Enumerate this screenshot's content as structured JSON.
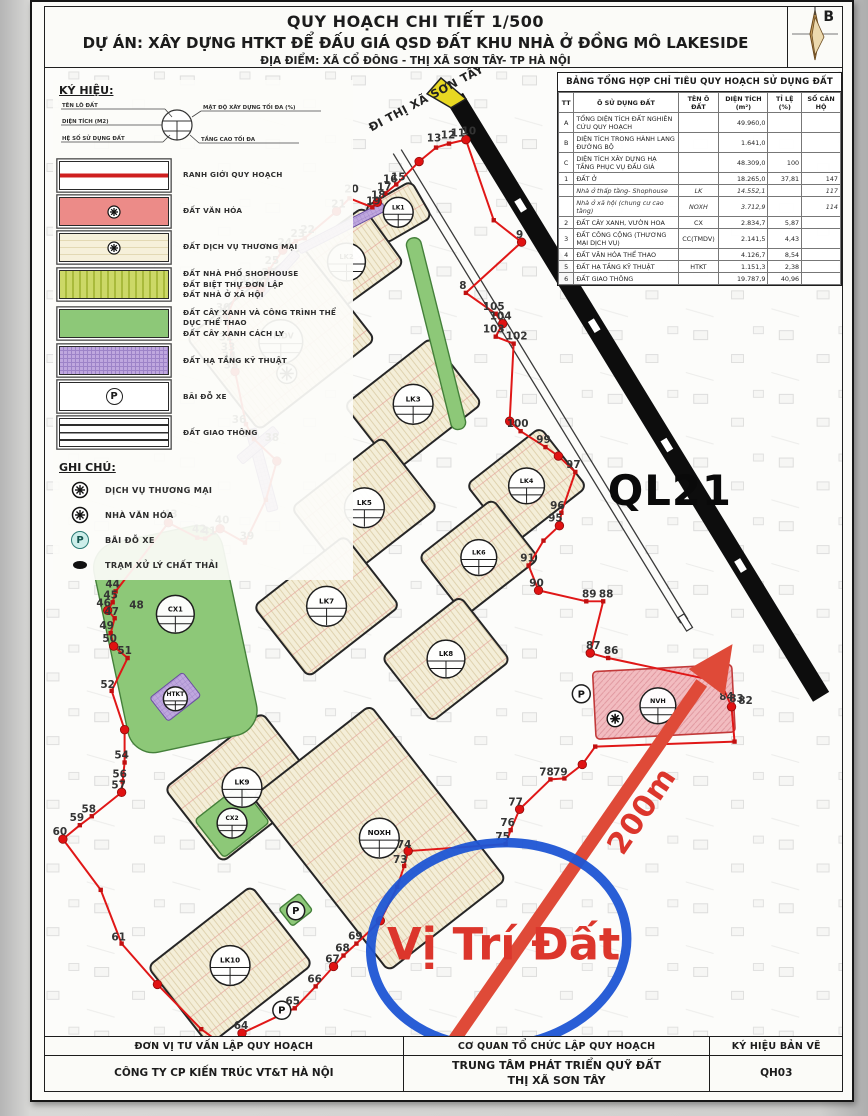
{
  "colors": {
    "boundary_red": "#e01717",
    "annotation_blue": "#1d55d4",
    "annotation_red": "#dc362c",
    "highway_black": "#0d0d0d",
    "block_cream": "#f4eed8",
    "green_area": "#8dc878",
    "purple_htkt": "#bfa7de",
    "pink_culture": "#f2bcc0",
    "direction_arrow_yellow": "#e8d822"
  },
  "title_block": {
    "line1": "QUY HOẠCH CHI TIẾT 1/500",
    "line2": "DỰ ÁN: XÂY DỰNG HTKT ĐỂ ĐẤU GIÁ QSD ĐẤT KHU NHÀ Ở ĐỒNG MÔ LAKESIDE",
    "line3": "ĐỊA ĐIỂM: XÃ CỔ ĐÔNG - THỊ XÃ SƠN TÂY- TP HÀ NỘI",
    "compass_label": "B"
  },
  "legend": {
    "heading": "KÝ HIỆU:",
    "stamp_labels": {
      "left": [
        "TÊN LÔ ĐẤT",
        "DIỆN TÍCH (M2)",
        "HỆ SỐ SỬ DỤNG ĐẤT"
      ],
      "right": [
        "MẬT ĐỘ XÂY DỰNG TỐI ĐA (%)",
        "TẦNG CAO TỐI ĐA"
      ]
    },
    "items": [
      {
        "key": "boundary",
        "lines": [
          "RANH GIỚI QUY HOẠCH"
        ]
      },
      {
        "key": "culture",
        "glyph": true,
        "lines": [
          "ĐẤT VĂN HÓA"
        ]
      },
      {
        "key": "commerce",
        "glyph": true,
        "lines": [
          "ĐẤT DỊCH VỤ THƯƠNG MẠI"
        ]
      },
      {
        "key": "shophouse",
        "lines": [
          "ĐẤT NHÀ PHỐ SHOPHOUSE",
          "ĐẤT BIỆT THỰ ĐƠN LẬP",
          "ĐẤT NHÀ Ở XÃ HỘI"
        ]
      },
      {
        "key": "green",
        "lines": [
          "ĐẤT CÂY XANH VÀ CÔNG TRÌNH THỂ DỤC THỂ THAO",
          "ĐẤT CÂY XANH CÁCH LY"
        ]
      },
      {
        "key": "htkt",
        "lines": [
          "ĐẤT HẠ TẦNG KỸ THUẬT"
        ]
      },
      {
        "key": "parking",
        "lines": [
          "BÃI ĐỖ XE"
        ]
      },
      {
        "key": "road",
        "lines": [
          "ĐẤT GIAO THÔNG"
        ]
      }
    ],
    "notes_heading": "GHI CHÚ:",
    "notes": [
      {
        "icon": "commerce",
        "label": "DỊCH VỤ THƯƠNG MẠI"
      },
      {
        "icon": "culture",
        "label": "NHÀ VĂN HÓA"
      },
      {
        "icon": "parking",
        "label": "BÃI ĐỖ XE"
      },
      {
        "icon": "waste",
        "label": "TRẠM XỬ LÝ CHẤT THẢI"
      }
    ]
  },
  "summary_table": {
    "title": "BẢNG TỔNG HỢP CHỈ TIÊU QUY HOẠCH SỬ DỤNG ĐẤT",
    "headers": [
      "TT",
      "Ô SỬ DỤNG ĐẤT",
      "TÊN Ô ĐẤT",
      "DIỆN TÍCH (m²)",
      "TỈ LỆ (%)",
      "SỐ CĂN HỘ"
    ],
    "rows": [
      {
        "tt": "A",
        "name": "TỔNG DIỆN TÍCH ĐẤT NGHIÊN CỨU QUY HOẠCH",
        "code": "",
        "area": "49.960,0",
        "pct": "",
        "units": ""
      },
      {
        "tt": "B",
        "name": "DIỆN TÍCH TRONG HÀNH LANG ĐƯỜNG BỘ",
        "code": "",
        "area": "1.641,0",
        "pct": "",
        "units": ""
      },
      {
        "tt": "C",
        "name": "DIỆN TÍCH XÂY DỰNG HẠ TẦNG PHỤC VỤ ĐẤU GIÁ",
        "code": "",
        "area": "48.309,0",
        "pct": "100",
        "units": ""
      },
      {
        "tt": "1",
        "name": "ĐẤT Ở",
        "code": "",
        "area": "18.265,0",
        "pct": "37,81",
        "units": "147"
      },
      {
        "tt": "",
        "name": "Nhà ở thấp tầng- Shophouse",
        "code": "LK",
        "area": "14.552,1",
        "pct": "",
        "units": "117",
        "sub": true
      },
      {
        "tt": "",
        "name": "Nhà ở xã hội (chung cư cao tầng)",
        "code": "NOXH",
        "area": "3.712,9",
        "pct": "",
        "units": "114",
        "sub": true
      },
      {
        "tt": "2",
        "name": "ĐẤT CÂY XANH, VƯỜN HOA",
        "code": "CX",
        "area": "2.834,7",
        "pct": "5,87",
        "units": ""
      },
      {
        "tt": "3",
        "name": "ĐẤT CÔNG CỘNG (THƯƠNG MẠI DỊCH VỤ)",
        "code": "CC(TMDV)",
        "area": "2.141,5",
        "pct": "4,43",
        "units": ""
      },
      {
        "tt": "4",
        "name": "ĐẤT VĂN HÓA THỂ THAO",
        "code": "",
        "area": "4.126,7",
        "pct": "8,54",
        "units": ""
      },
      {
        "tt": "5",
        "name": "ĐẤT HẠ TẦNG KỸ THUẬT",
        "code": "HTKT",
        "area": "1.151,3",
        "pct": "2,38",
        "units": ""
      },
      {
        "tt": "6",
        "name": "ĐẤT GIAO THÔNG",
        "code": "",
        "area": "19.787,9",
        "pct": "40,96",
        "units": ""
      }
    ]
  },
  "map": {
    "annotations": {
      "ql21": "QL21",
      "distance": "200m",
      "site_label": "Vị Trí Đất",
      "direction": "ĐI THỊ XÃ SƠN TÂY"
    },
    "blocks": [
      {
        "x": 399,
        "y": 211,
        "w": 54,
        "h": 42,
        "rot": -30,
        "f": "cream"
      },
      {
        "x": 347,
        "y": 261,
        "w": 92,
        "h": 70,
        "rot": -36,
        "f": "cream"
      },
      {
        "x": 281,
        "y": 338,
        "w": 148,
        "h": 118,
        "rot": -38,
        "f": "cream"
      },
      {
        "x": 414,
        "y": 404,
        "w": 110,
        "h": 84,
        "rot": -38,
        "f": "cream"
      },
      {
        "x": 365,
        "y": 508,
        "w": 116,
        "h": 90,
        "rot": -38,
        "f": "cream"
      },
      {
        "x": 528,
        "y": 486,
        "w": 94,
        "h": 76,
        "rot": -38,
        "f": "cream"
      },
      {
        "x": 480,
        "y": 558,
        "w": 94,
        "h": 76,
        "rot": -38,
        "f": "cream"
      },
      {
        "x": 327,
        "y": 607,
        "w": 116,
        "h": 90,
        "rot": -38,
        "f": "cream"
      },
      {
        "x": 447,
        "y": 660,
        "w": 100,
        "h": 82,
        "rot": -38,
        "f": "cream"
      },
      {
        "x": 242,
        "y": 789,
        "w": 124,
        "h": 94,
        "rot": -38,
        "f": "cream"
      },
      {
        "x": 230,
        "y": 968,
        "w": 132,
        "h": 100,
        "rot": -38,
        "f": "cream"
      },
      {
        "x": 380,
        "y": 840,
        "w": 150,
        "h": 222,
        "rot": -38,
        "f": "cream"
      },
      {
        "x": 175,
        "y": 640,
        "w": 132,
        "h": 215,
        "rot": -12,
        "f": "green",
        "rx": 26
      },
      {
        "x": 232,
        "y": 823,
        "w": 58,
        "h": 48,
        "rot": -38,
        "f": "green",
        "rx": 4
      },
      {
        "x": 437,
        "y": 333,
        "w": 15,
        "h": 198,
        "rot": -14,
        "f": "green",
        "rx": 7
      },
      {
        "x": 296,
        "y": 912,
        "w": 26,
        "h": 22,
        "rot": -38,
        "f": "green",
        "rx": 3
      },
      {
        "x": 342,
        "y": 227,
        "w": 96,
        "h": 9,
        "rot": -27,
        "f": "purple",
        "rx": 2
      },
      {
        "x": 277,
        "y": 274,
        "w": 60,
        "h": 9,
        "rot": -48,
        "f": "purple",
        "rx": 2
      },
      {
        "x": 262,
        "y": 470,
        "w": 11,
        "h": 85,
        "rot": -15,
        "f": "purple",
        "rx": 2
      },
      {
        "x": 258,
        "y": 445,
        "w": 48,
        "h": 10,
        "rot": -40,
        "f": "purple",
        "rx": 2
      },
      {
        "x": 175,
        "y": 698,
        "w": 42,
        "h": 30,
        "rot": -38,
        "f": "purple",
        "rx": 3
      },
      {
        "x": 666,
        "y": 703,
        "w": 140,
        "h": 68,
        "rot": -3,
        "f": "pink",
        "rx": 4
      }
    ],
    "stamps": [
      {
        "x": 399,
        "y": 211,
        "t": "LK1",
        "r": 15
      },
      {
        "x": 347,
        "y": 261,
        "t": "LK2",
        "r": 19
      },
      {
        "x": 281,
        "y": 341,
        "t": "TMDV",
        "r": 22
      },
      {
        "x": 414,
        "y": 404,
        "t": "LK3",
        "r": 20
      },
      {
        "x": 528,
        "y": 486,
        "t": "LK4",
        "r": 18
      },
      {
        "x": 365,
        "y": 508,
        "t": "LK5",
        "r": 20
      },
      {
        "x": 480,
        "y": 558,
        "t": "LK6",
        "r": 18
      },
      {
        "x": 327,
        "y": 607,
        "t": "LK7",
        "r": 20
      },
      {
        "x": 447,
        "y": 660,
        "t": "LK8",
        "r": 19
      },
      {
        "x": 175,
        "y": 615,
        "t": "CX1",
        "r": 19
      },
      {
        "x": 242,
        "y": 789,
        "t": "LK9",
        "r": 20
      },
      {
        "x": 232,
        "y": 825,
        "t": "CX2",
        "r": 15
      },
      {
        "x": 380,
        "y": 840,
        "t": "NOXH",
        "r": 20
      },
      {
        "x": 230,
        "y": 968,
        "t": "LK10",
        "r": 20
      },
      {
        "x": 660,
        "y": 707,
        "t": "NVH",
        "r": 18
      },
      {
        "x": 175,
        "y": 700,
        "t": "HTKT",
        "r": 12
      },
      {
        "x": 583,
        "y": 695,
        "t": "P",
        "r": 9
      },
      {
        "x": 296,
        "y": 913,
        "t": "P",
        "r": 9
      },
      {
        "x": 282,
        "y": 1013,
        "t": "P",
        "r": 9
      }
    ],
    "icons": [
      {
        "x": 287,
        "y": 373,
        "r": 10,
        "name": "commerce-icon"
      },
      {
        "x": 617,
        "y": 720,
        "r": 8,
        "name": "culture-icon"
      }
    ],
    "boundary": [
      [
        467,
        138
      ],
      [
        450,
        142
      ],
      [
        437,
        146
      ],
      [
        420,
        160
      ],
      [
        397,
        183
      ],
      [
        386,
        192
      ],
      [
        378,
        201
      ],
      [
        373,
        206
      ],
      [
        350,
        197
      ],
      [
        337,
        210
      ],
      [
        305,
        237
      ],
      [
        296,
        240
      ],
      [
        283,
        249
      ],
      [
        270,
        268
      ],
      [
        267,
        279
      ],
      [
        261,
        288
      ],
      [
        251,
        286
      ],
      [
        239,
        287
      ],
      [
        227,
        315
      ],
      [
        229,
        335
      ],
      [
        232,
        353
      ],
      [
        235,
        371
      ],
      [
        246,
        424
      ],
      [
        254,
        439
      ],
      [
        277,
        461
      ],
      [
        266,
        500
      ],
      [
        245,
        543
      ],
      [
        220,
        529
      ],
      [
        205,
        539
      ],
      [
        197,
        538
      ],
      [
        168,
        523
      ],
      [
        115,
        592
      ],
      [
        112,
        603
      ],
      [
        107,
        611
      ],
      [
        114,
        619
      ],
      [
        110,
        634
      ],
      [
        113,
        647
      ],
      [
        127,
        659
      ],
      [
        111,
        692
      ],
      [
        124,
        731
      ],
      [
        124,
        764
      ],
      [
        122,
        783
      ],
      [
        121,
        794
      ],
      [
        91,
        818
      ],
      [
        79,
        827
      ],
      [
        62,
        841
      ],
      [
        100,
        892
      ],
      [
        121,
        946
      ],
      [
        157,
        987
      ],
      [
        201,
        1032
      ],
      [
        227,
        1051
      ],
      [
        242,
        1036
      ],
      [
        295,
        1011
      ],
      [
        316,
        989
      ],
      [
        334,
        969
      ],
      [
        344,
        958
      ],
      [
        357,
        946
      ],
      [
        381,
        923
      ],
      [
        398,
        889
      ],
      [
        405,
        868
      ],
      [
        409,
        853
      ],
      [
        507,
        846
      ],
      [
        512,
        832
      ],
      [
        521,
        811
      ],
      [
        552,
        781
      ],
      [
        566,
        780
      ],
      [
        584,
        766
      ],
      [
        597,
        748
      ],
      [
        737,
        743
      ],
      [
        734,
        708
      ],
      [
        723,
        683
      ],
      [
        610,
        659
      ],
      [
        592,
        654
      ],
      [
        605,
        602
      ],
      [
        588,
        602
      ],
      [
        540,
        591
      ],
      [
        530,
        566
      ],
      [
        545,
        541
      ],
      [
        561,
        526
      ],
      [
        563,
        513
      ],
      [
        577,
        472
      ],
      [
        560,
        456
      ],
      [
        547,
        447
      ],
      [
        522,
        431
      ],
      [
        511,
        421
      ],
      [
        515,
        343
      ],
      [
        497,
        336
      ],
      [
        504,
        323
      ],
      [
        497,
        313
      ],
      [
        467,
        292
      ],
      [
        523,
        241
      ],
      [
        495,
        219
      ]
    ],
    "point_labels": [
      [
        10,
        470,
        133
      ],
      [
        11,
        459,
        135
      ],
      [
        12,
        449,
        137
      ],
      [
        13,
        435,
        140
      ],
      [
        15,
        399,
        179
      ],
      [
        16,
        391,
        181
      ],
      [
        17,
        385,
        189
      ],
      [
        18,
        379,
        197
      ],
      [
        19,
        374,
        203
      ],
      [
        20,
        352,
        191
      ],
      [
        21,
        339,
        206
      ],
      [
        22,
        308,
        232
      ],
      [
        23,
        298,
        236
      ],
      [
        24,
        285,
        245
      ],
      [
        25,
        272,
        263
      ],
      [
        26,
        269,
        275
      ],
      [
        27,
        263,
        285
      ],
      [
        28,
        251,
        282
      ],
      [
        29,
        239,
        282
      ],
      [
        30,
        223,
        310
      ],
      [
        31,
        223,
        322
      ],
      [
        32,
        226,
        340
      ],
      [
        33,
        228,
        350
      ],
      [
        34,
        229,
        359
      ],
      [
        35,
        231,
        368
      ],
      [
        36,
        239,
        423
      ],
      [
        37,
        249,
        437
      ],
      [
        38,
        272,
        441
      ],
      [
        39,
        247,
        540
      ],
      [
        40,
        222,
        524
      ],
      [
        41,
        209,
        535
      ],
      [
        42,
        199,
        533
      ],
      [
        43,
        170,
        518
      ],
      [
        44,
        112,
        588
      ],
      [
        45,
        110,
        599
      ],
      [
        46,
        103,
        607
      ],
      [
        47,
        111,
        616
      ],
      [
        48,
        136,
        609
      ],
      [
        49,
        106,
        630
      ],
      [
        50,
        109,
        643
      ],
      [
        51,
        124,
        655
      ],
      [
        52,
        107,
        689
      ],
      [
        54,
        121,
        760
      ],
      [
        56,
        119,
        779
      ],
      [
        57,
        118,
        790
      ],
      [
        58,
        88,
        814
      ],
      [
        59,
        76,
        823
      ],
      [
        60,
        59,
        837
      ],
      [
        61,
        118,
        943
      ],
      [
        64,
        241,
        1032
      ],
      [
        65,
        293,
        1007
      ],
      [
        66,
        315,
        985
      ],
      [
        67,
        333,
        965
      ],
      [
        68,
        343,
        954
      ],
      [
        69,
        356,
        942
      ],
      [
        73,
        401,
        865
      ],
      [
        74,
        405,
        850
      ],
      [
        75,
        504,
        842
      ],
      [
        76,
        509,
        828
      ],
      [
        77,
        517,
        807
      ],
      [
        78,
        548,
        777
      ],
      [
        79,
        562,
        777
      ],
      [
        82,
        748,
        705
      ],
      [
        83,
        739,
        703
      ],
      [
        84,
        729,
        701
      ],
      [
        85,
        722,
        678
      ],
      [
        86,
        613,
        655
      ],
      [
        87,
        595,
        650
      ],
      [
        88,
        608,
        598
      ],
      [
        89,
        591,
        598
      ],
      [
        90,
        538,
        587
      ],
      [
        91,
        529,
        562
      ],
      [
        95,
        557,
        522
      ],
      [
        96,
        559,
        509
      ],
      [
        97,
        575,
        468
      ],
      [
        99,
        545,
        443
      ],
      [
        100,
        519,
        427
      ],
      [
        102,
        518,
        339
      ],
      [
        103,
        495,
        332
      ],
      [
        104,
        502,
        319
      ],
      [
        105,
        495,
        309
      ],
      [
        8,
        464,
        288
      ],
      [
        9,
        521,
        237
      ]
    ]
  },
  "footer": {
    "col1_header": "ĐƠN VỊ TƯ VẤN LẬP QUY HOẠCH",
    "col1_value": "CÔNG TY CP KIẾN TRÚC VT&T HÀ NỘI",
    "col2_header": "CƠ QUAN TỔ CHỨC LẬP QUY HOẠCH",
    "col2_value_line1": "TRUNG TÂM PHÁT TRIỂN QUỸ ĐẤT",
    "col2_value_line2": "THỊ XÃ SƠN TÂY",
    "col3_header": "KÝ HIỆU BẢN VẼ",
    "col3_value": "QH03"
  }
}
